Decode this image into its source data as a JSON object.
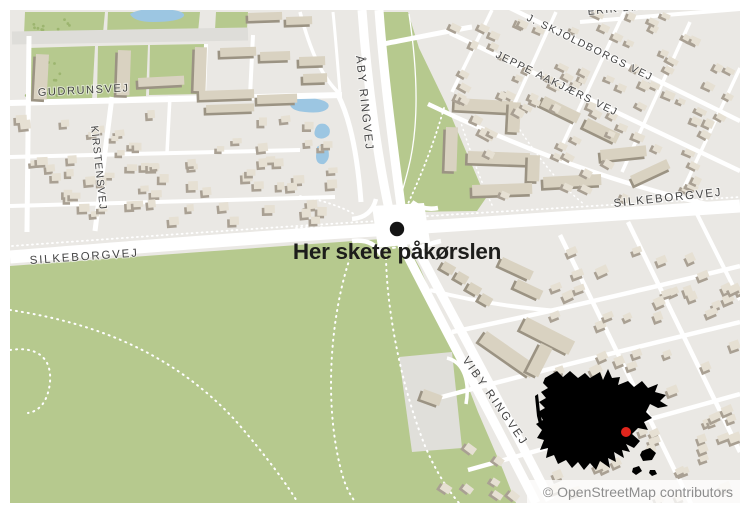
{
  "annotation": {
    "label": "Her skete påkørslen",
    "label_transform": "translate(397,259)",
    "marker_transform": "translate(397,229)",
    "marker_color": "#141414",
    "label_color": "#1d1d1b"
  },
  "attribution": {
    "text": "© OpenStreetMap contributors",
    "strip": {
      "x": 527,
      "y": 480,
      "w": 213,
      "h": 23
    },
    "text_x": 733,
    "text_y": 497,
    "color": "#8e8e8e"
  },
  "street_labels": [
    {
      "text": "GUDRUNSVEJ",
      "transform": "translate(38,96) rotate(-3)",
      "size": 11,
      "spacing": 1.6
    },
    {
      "text": "KIRSTENSVEJ",
      "transform": "translate(91,126) rotate(84)",
      "size": 10.5,
      "spacing": 1.2
    },
    {
      "text": "ÅBY RINGVEJ",
      "transform": "translate(356,56) rotate(84)",
      "size": 11.5,
      "spacing": 1.8
    },
    {
      "text": "SILKEBORGVEJ",
      "transform": "translate(30,264) rotate(-4)",
      "size": 11.5,
      "spacing": 1.8
    },
    {
      "text": "SILKEBORGVEJ",
      "transform": "translate(614,207) rotate(-6)",
      "size": 11.5,
      "spacing": 1.8
    },
    {
      "text": "VIBY RINGVEJ",
      "transform": "translate(462,360) rotate(55)",
      "size": 11.5,
      "spacing": 2.2
    },
    {
      "text": "JEPPE AAKJÆRS VEJ",
      "transform": "translate(495,57) rotate(26)",
      "size": 10.5,
      "spacing": 1.5
    },
    {
      "text": "J. SKJOLDBORGS VEJ",
      "transform": "translate(526,20) rotate(26)",
      "size": 10.5,
      "spacing": 1.5
    },
    {
      "text": "ERIK BØGHS VEJ",
      "transform": "translate(588,15) rotate(-6)",
      "size": 10.5,
      "spacing": 1.5
    }
  ],
  "colors": {
    "land": "#eae8e4",
    "park": "#b6c98e",
    "water": "#9cc6e2",
    "road": "#ffffff",
    "road_gray": "#deddd9",
    "parking": "#e0dfda",
    "tree": "#9cb56f",
    "bldg_top": "#e6e0d3",
    "bldg_side": "#a9a093",
    "block_top": "#d9d2c1",
    "block_side": "#9b9383",
    "inset": "#000000",
    "inset_dot": "#e0251c"
  },
  "map": {
    "frame": {
      "x": 10,
      "y": 10,
      "w": 730,
      "h": 493
    },
    "parks": [
      "10,266 200,252 396,238 408,246 420,268 436,305 452,345 478,412 503,470 516,503 10,503",
      "378,12 408,12 419,48 446,104 468,156 486,198 477,211 402,212 392,155 382,75",
      "25,12 105,12 103,33 24,35",
      "108,12 200,12 198,32 107,34",
      "28,48 95,46 92,101 60,104 27,101",
      "98,46 148,45 146,96 97,98",
      "150,45 205,44 202,94 149,95",
      "216,12 248,12 247,29 215,30"
    ],
    "parking": "399,357 452,352 462,448 412,452",
    "water": [
      "M130,14 Q140,8 160,9 Q186,10 184,16 Q179,22 153,22 Q134,22 130,14 Z",
      "M290,105 Q294,96 312,98 Q332,101 328,108 Q323,114 305,112 Q292,111 290,105 Z",
      "M315,130 Q317,122 325,124 Q332,128 329,135 Q324,140 318,138 Q313,136 315,130 Z",
      "M317,147 Q325,141 328,149 Q331,159 324,164 Q316,165 316,156 Z"
    ],
    "roads_gray": [
      {
        "d": "M12,38 L248,34",
        "w": 13
      }
    ],
    "roads": [
      {
        "d": "M10,257 C150,246 300,234 394,229",
        "w": 13
      },
      {
        "d": "M394,229 L740,206",
        "w": 13
      },
      {
        "d": "M362,10 C367,80 378,165 393,227",
        "w": 9
      },
      {
        "d": "M379,10 C384,80 395,160 403,221",
        "w": 9
      },
      {
        "d": "M393,227 C418,278 478,390 536,503",
        "w": 9
      },
      {
        "d": "M403,221 C428,272 492,385 550,500",
        "w": 9
      },
      {
        "d": "M10,103 L342,95",
        "w": 6
      },
      {
        "d": "M112,97 L95,231",
        "w": 5
      },
      {
        "d": "M29,36 L27,232",
        "w": 5
      },
      {
        "d": "M253,35 L250,96",
        "w": 4
      },
      {
        "d": "M206,44 L204,96",
        "w": 4
      },
      {
        "d": "M10,157 L300,150",
        "w": 4
      },
      {
        "d": "M10,206 L335,197",
        "w": 4
      },
      {
        "d": "M170,96 L167,153",
        "w": 3.5
      },
      {
        "d": "M338,95 C352,122 358,162 361,202",
        "w": 5
      },
      {
        "d": "M300,12 C310,50 322,78 340,94",
        "w": 3.5
      },
      {
        "d": "M333,12 C336,42 338,70 340,92",
        "w": 3
      },
      {
        "d": "M383,44 C420,37 448,31 472,27",
        "w": 5
      },
      {
        "d": "M450,33 L740,171",
        "w": 4.5
      },
      {
        "d": "M510,8 L740,121",
        "w": 4.5
      },
      {
        "d": "M580,22 L740,9",
        "w": 4
      },
      {
        "d": "M428,104 C540,158 645,192 725,208",
        "w": 4.5
      },
      {
        "d": "M452,92 L492,10",
        "w": 3.5
      },
      {
        "d": "M508,118 L556,12",
        "w": 3.5
      },
      {
        "d": "M560,150 L625,10",
        "w": 3.5
      },
      {
        "d": "M622,172 L690,22",
        "w": 3.5
      },
      {
        "d": "M680,196 L740,68",
        "w": 3.5
      },
      {
        "d": "M560,235 L695,512",
        "w": 4.5
      },
      {
        "d": "M628,222 L740,452",
        "w": 4.5
      },
      {
        "d": "M695,210 L740,300",
        "w": 4
      },
      {
        "d": "M452,332 C550,312 650,288 740,266",
        "w": 4.5
      },
      {
        "d": "M438,398 C550,368 650,344 740,322",
        "w": 4.5
      },
      {
        "d": "M468,470 C580,438 670,414 740,394",
        "w": 4.5
      },
      {
        "d": "M430,290 C475,302 520,308 558,311",
        "w": 4
      },
      {
        "d": "M447,358 C464,362 470,382 466,404",
        "w": 3.5
      },
      {
        "d": "M352,219 C365,218 373,211 376,199",
        "w": 4.5
      },
      {
        "d": "M352,241 C368,239 377,245 381,255",
        "w": 4.5
      },
      {
        "d": "M412,202 C420,208 428,210 438,208",
        "w": 4.5
      },
      {
        "d": "M413,252 C421,247 431,243 441,241",
        "w": 4.5
      },
      {
        "d": "M409,14 C416,60 421,120 408,170 C404,186 400,198 397,210",
        "w": 1.3
      }
    ],
    "junction": "372,206 424,203 430,242 378,248",
    "dashed": [
      {
        "d": "M10,310 C90,322 170,350 235,420 C268,458 288,486 298,503",
        "w": 2,
        "dash": "1 5"
      },
      {
        "d": "M10,350 C36,346 52,357 50,382 C48,401 40,411 28,413",
        "w": 2,
        "dash": "1 5"
      },
      {
        "d": "M352,252 C331,310 323,400 341,470 C345,486 350,495 356,503",
        "w": 2,
        "dash": "1 5"
      },
      {
        "d": "M386,246 C385,300 399,380 425,446 C436,472 448,490 459,503",
        "w": 2,
        "dash": "1 5"
      },
      {
        "d": "M12,246 C150,236 290,226 378,221",
        "w": 1.8,
        "dash": "1 4"
      },
      {
        "d": "M412,217 L740,197",
        "w": 1.8,
        "dash": "1 4"
      },
      {
        "d": "M444,108 C432,150 418,182 406,208",
        "w": 1.8,
        "dash": "1 4"
      },
      {
        "d": "M300,196 C322,200 342,207 354,214",
        "w": 1.8,
        "dash": "1 4"
      },
      {
        "d": "M296,228 C320,225 344,229 358,233",
        "w": 1.8,
        "dash": "1 4"
      },
      {
        "d": "M378,211 L420,208",
        "w": 2,
        "dash": "2 4"
      },
      {
        "d": "M381,249 L423,245",
        "w": 2,
        "dash": "2 4"
      },
      {
        "d": "M460,120 C470,150 480,180 492,205",
        "w": 1.5,
        "dash": "1 4"
      },
      {
        "d": "M520,130 C540,160 560,185 585,205",
        "w": 1.5,
        "dash": "1 4"
      }
    ],
    "blocks": [
      [
        36,
        54,
        13,
        45,
        3
      ],
      [
        118,
        50,
        13,
        45,
        2
      ],
      [
        195,
        47,
        12,
        44,
        2
      ],
      [
        138,
        78,
        46,
        9,
        -3
      ],
      [
        220,
        48,
        36,
        9,
        -2
      ],
      [
        260,
        52,
        30,
        9,
        -2
      ],
      [
        199,
        91,
        55,
        9,
        -2
      ],
      [
        257,
        95,
        40,
        9,
        -2
      ],
      [
        206,
        105,
        48,
        8,
        -2
      ],
      [
        248,
        13,
        34,
        8,
        -2
      ],
      [
        286,
        17,
        26,
        8,
        -2
      ],
      [
        299,
        57,
        26,
        9,
        -2
      ],
      [
        303,
        74,
        24,
        9,
        -2
      ],
      [
        455,
        98,
        58,
        12,
        3
      ],
      [
        509,
        102,
        12,
        30,
        3
      ],
      [
        446,
        127,
        12,
        44,
        2
      ],
      [
        468,
        151,
        62,
        12,
        2
      ],
      [
        528,
        155,
        12,
        26,
        2
      ],
      [
        472,
        185,
        60,
        11,
        -2
      ],
      [
        545,
        96,
        40,
        11,
        26
      ],
      [
        588,
        118,
        36,
        11,
        26
      ],
      [
        543,
        177,
        58,
        11,
        -3
      ],
      [
        600,
        150,
        46,
        11,
        -6
      ],
      [
        630,
        176,
        40,
        10,
        -25
      ],
      [
        487,
        331,
        62,
        14,
        35
      ],
      [
        527,
        317,
        54,
        15,
        27
      ],
      [
        541,
        343,
        13,
        32,
        27
      ],
      [
        424,
        389,
        20,
        11,
        20
      ],
      [
        445,
        261,
        13,
        9,
        30
      ],
      [
        459,
        271,
        12,
        9,
        30
      ],
      [
        471,
        282,
        13,
        9,
        30
      ],
      [
        483,
        293,
        12,
        9,
        30
      ],
      [
        503,
        257,
        34,
        10,
        25
      ],
      [
        518,
        279,
        28,
        10,
        25
      ]
    ],
    "building_clusters": [
      {
        "seed": 7,
        "x": 12,
        "y": 108,
        "w": 318,
        "h": 118,
        "count": 72,
        "minw": 7,
        "maxw": 11,
        "minh": 5,
        "maxh": 9,
        "rot": -3,
        "avoid": "silkeborgW"
      },
      {
        "seed": 11,
        "x": 445,
        "y": 8,
        "w": 292,
        "h": 190,
        "count": 95,
        "minw": 7,
        "maxw": 11,
        "minh": 5,
        "maxh": 8,
        "rot": 26,
        "avoid": "greenP2"
      },
      {
        "seed": 23,
        "x": 548,
        "y": 232,
        "w": 190,
        "h": 266,
        "count": 62,
        "minw": 8,
        "maxw": 12,
        "minh": 6,
        "maxh": 9,
        "rot": -22
      },
      {
        "seed": 31,
        "x": 440,
        "y": 438,
        "w": 82,
        "h": 62,
        "count": 7,
        "minw": 8,
        "maxw": 11,
        "minh": 6,
        "maxh": 8,
        "rot": 35
      }
    ],
    "tree_clusters": [
      {
        "seed": 3,
        "x": 30,
        "y": 62,
        "w": 34,
        "h": 38,
        "count": 16
      },
      {
        "seed": 5,
        "x": 24,
        "y": 86,
        "w": 26,
        "h": 16,
        "count": 8
      },
      {
        "seed": 9,
        "x": 26,
        "y": 13,
        "w": 60,
        "h": 18,
        "count": 10
      }
    ]
  },
  "inset": {
    "main_path": "M545,378 L557,371 L563,377 L570,371 L578,378 L585,373 L590,378 L600,372 L603,380 L608,369 L612,378 L620,377 L618,385 L628,381 L634,387 L642,381 L648,388 L658,384 L655,392 L666,395 L660,401 L668,406 L658,408 L650,404 L646,412 L652,418 L644,422 L648,430 L638,428 L632,434 L640,441 L634,448 L626,444 L630,452 L622,450 L624,458 L614,452 L616,462 L608,458 L610,468 L600,461 L596,470 L590,463 L584,470 L578,462 L572,468 L566,460 L558,464 L554,455 L546,458 L548,448 L540,450 L544,440 L537,438 L542,430 L536,424 L543,420 L538,412 L545,408 L539,402 L546,398 L541,392 L548,388 L543,383 Z",
    "islands": [
      "M642,451 l8,-3 l6,5 l-4,7 l-9,1 l-3,-6 Z",
      "M633,468 l6,-2 l3,5 l-6,4 l-4,-3 Z",
      "M650,470 l5,0 l2,4 l-5,2 l-3,-3 Z",
      "M535,396 l3,-2 l2,18 l3,14 l-3,2 l-3,-12 Z"
    ],
    "dot": {
      "x": 626,
      "y": 432,
      "r": 5
    }
  }
}
